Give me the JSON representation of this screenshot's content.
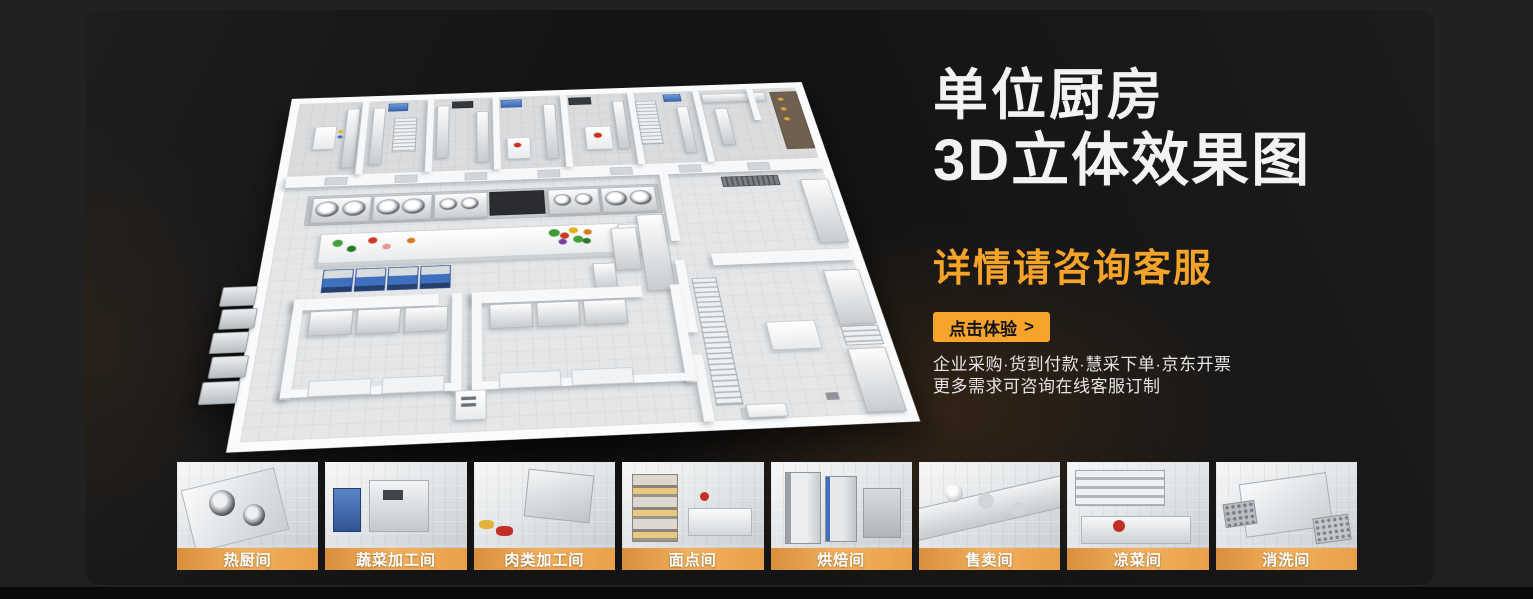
{
  "colors": {
    "background": "#212122",
    "card": "#141414",
    "accent": "#F6A42C",
    "title": "#F3F3F3",
    "thumb_label_gradient_from": "#D98F3D",
    "thumb_label_gradient_to": "#F2B05C",
    "footer": "#0A0A0A"
  },
  "hero": {
    "title_line1": "单位厨房",
    "title_line2": "3D立体效果图",
    "subtitle": "详情请咨询客服",
    "cta_label": "点击体验",
    "cta_arrow": ">",
    "info_line1": "企业采购·货到付款·慧采下单·京东开票",
    "info_line2": "更多需求可咨询在线客服订制"
  },
  "thumbnails": [
    {
      "label": "热厨间"
    },
    {
      "label": "蔬菜加工间"
    },
    {
      "label": "肉类加工间"
    },
    {
      "label": "面点间"
    },
    {
      "label": "烘焙间"
    },
    {
      "label": "售卖间"
    },
    {
      "label": "凉菜间"
    },
    {
      "label": "消洗间"
    }
  ]
}
